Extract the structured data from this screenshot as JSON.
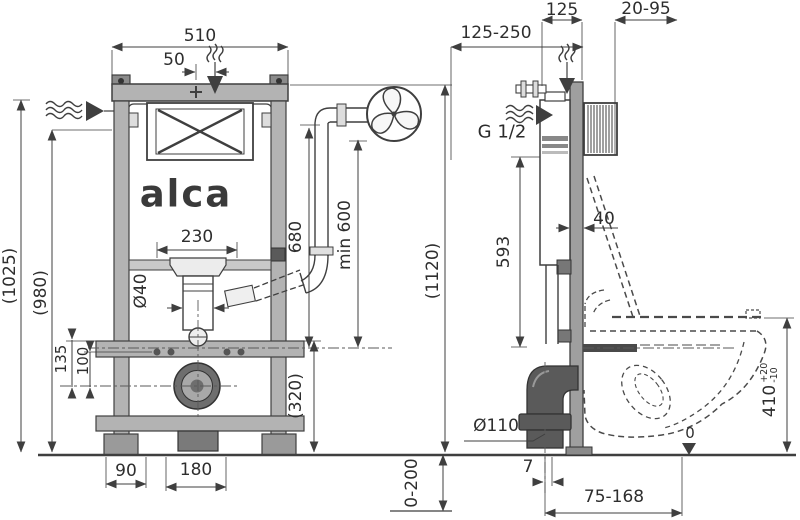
{
  "brand": {
    "logo_text": "alca"
  },
  "front": {
    "overall_width": "510",
    "vent_offset": "50",
    "height_1025": "(1025)",
    "height_980": "(980)",
    "opening_width": "230",
    "flush_pipe_diameter": "Ø40",
    "vent_pipe_height": "680",
    "vent_min_height": "min 600",
    "frame_height": "(1120)",
    "bracket_height_135": "135",
    "bracket_height_100": "100",
    "lower_frame_height": "(320)",
    "foot_dim_90": "90",
    "drain_spacing_180": "180",
    "leg_adjust_range": "0-200"
  },
  "side": {
    "depth_range": "125-250",
    "frame_depth": "125",
    "wall_clearance": "20-95",
    "water_connection": "G 1/2",
    "cistern_height": "593",
    "profile_width": "40",
    "waste_pipe_diameter": "Ø110",
    "bowl_height": "410",
    "bowl_height_tol_plus": "+20",
    "bowl_height_tol_minus": "-10",
    "floor_datum": "0",
    "outlet_offset": "7",
    "waste_outlet_range": "75-168"
  }
}
